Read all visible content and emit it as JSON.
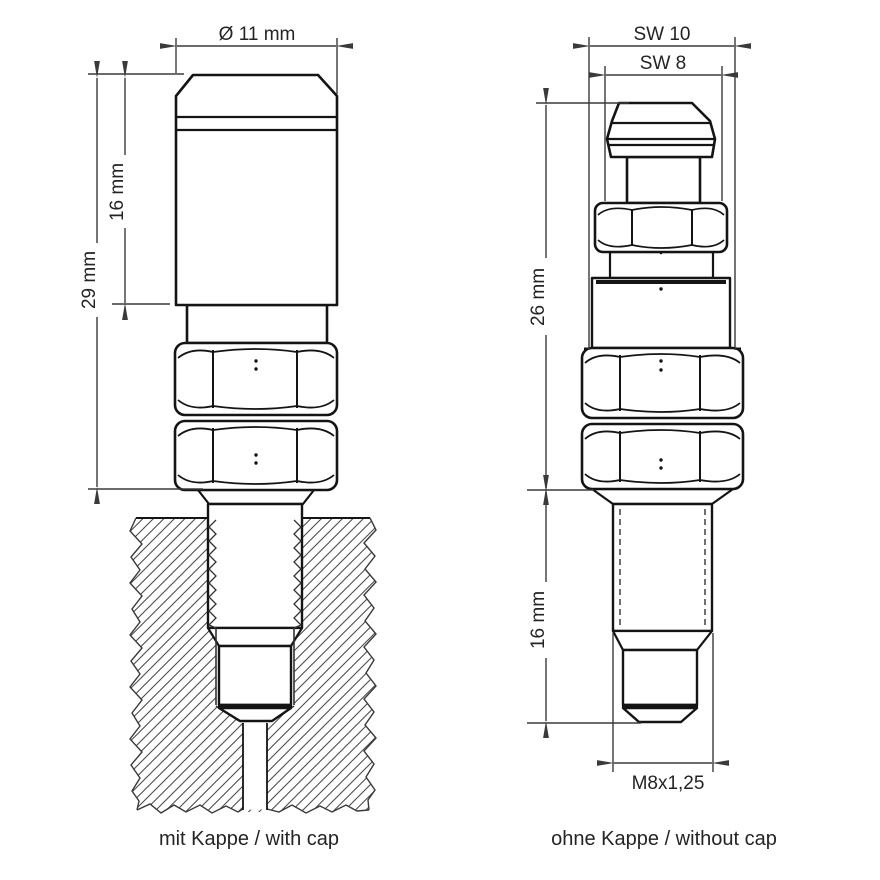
{
  "figures": {
    "left": {
      "caption": "mit Kappe / with cap",
      "dims": {
        "diameter": "Ø 11 mm",
        "cap_height": "16 mm",
        "overall_height": "29 mm"
      }
    },
    "right": {
      "caption": "ohne Kappe / without cap",
      "dims": {
        "wrench_large": "SW 10",
        "wrench_small": "SW 8",
        "upper_height": "26 mm",
        "thread_length": "16 mm",
        "thread_spec": "M8x1,25"
      }
    }
  },
  "colors": {
    "object_line": "#141414",
    "dimension_line": "#3a3a3a",
    "hatch": "#4d4d4d",
    "background": "#ffffff",
    "text": "#242424"
  }
}
